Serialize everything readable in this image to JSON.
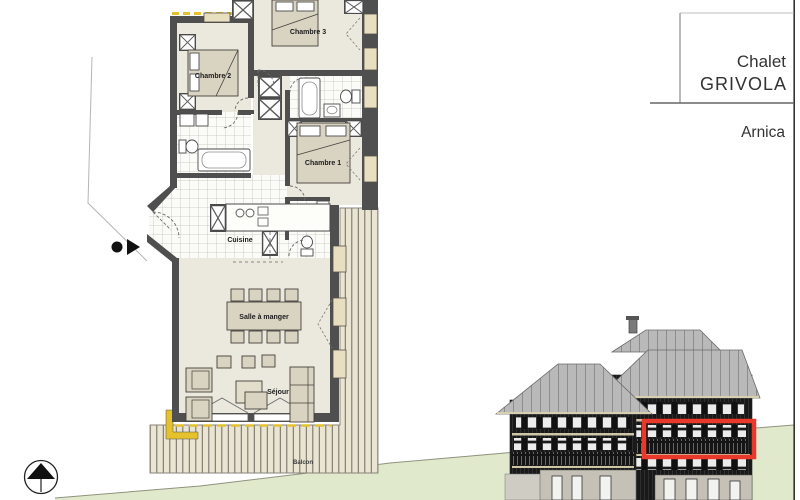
{
  "title_block": {
    "building_line1": "Chalet",
    "building_line2": "GRIVOLA",
    "apartment_name": "Arnica"
  },
  "floor_plan": {
    "rooms": {
      "chambre1": "Chambre 1",
      "chambre2": "Chambre 2",
      "chambre3": "Chambre 3",
      "cuisine": "Cuisine",
      "salle_a_manger": "Salle à manger",
      "sejour": "Séjour",
      "balcon": "Balcon"
    }
  },
  "colors": {
    "wall": "#4f4f4f",
    "room_floor": "#ebe9de",
    "furniture": "#d9d3c2",
    "deck": "#e9e5d2",
    "insulation": "#e6c12e",
    "ground_green": "#e0e9cc",
    "roof_gray": "#b9b9b9",
    "facade_dark": "#191919",
    "highlight_red": "#e8392b"
  }
}
